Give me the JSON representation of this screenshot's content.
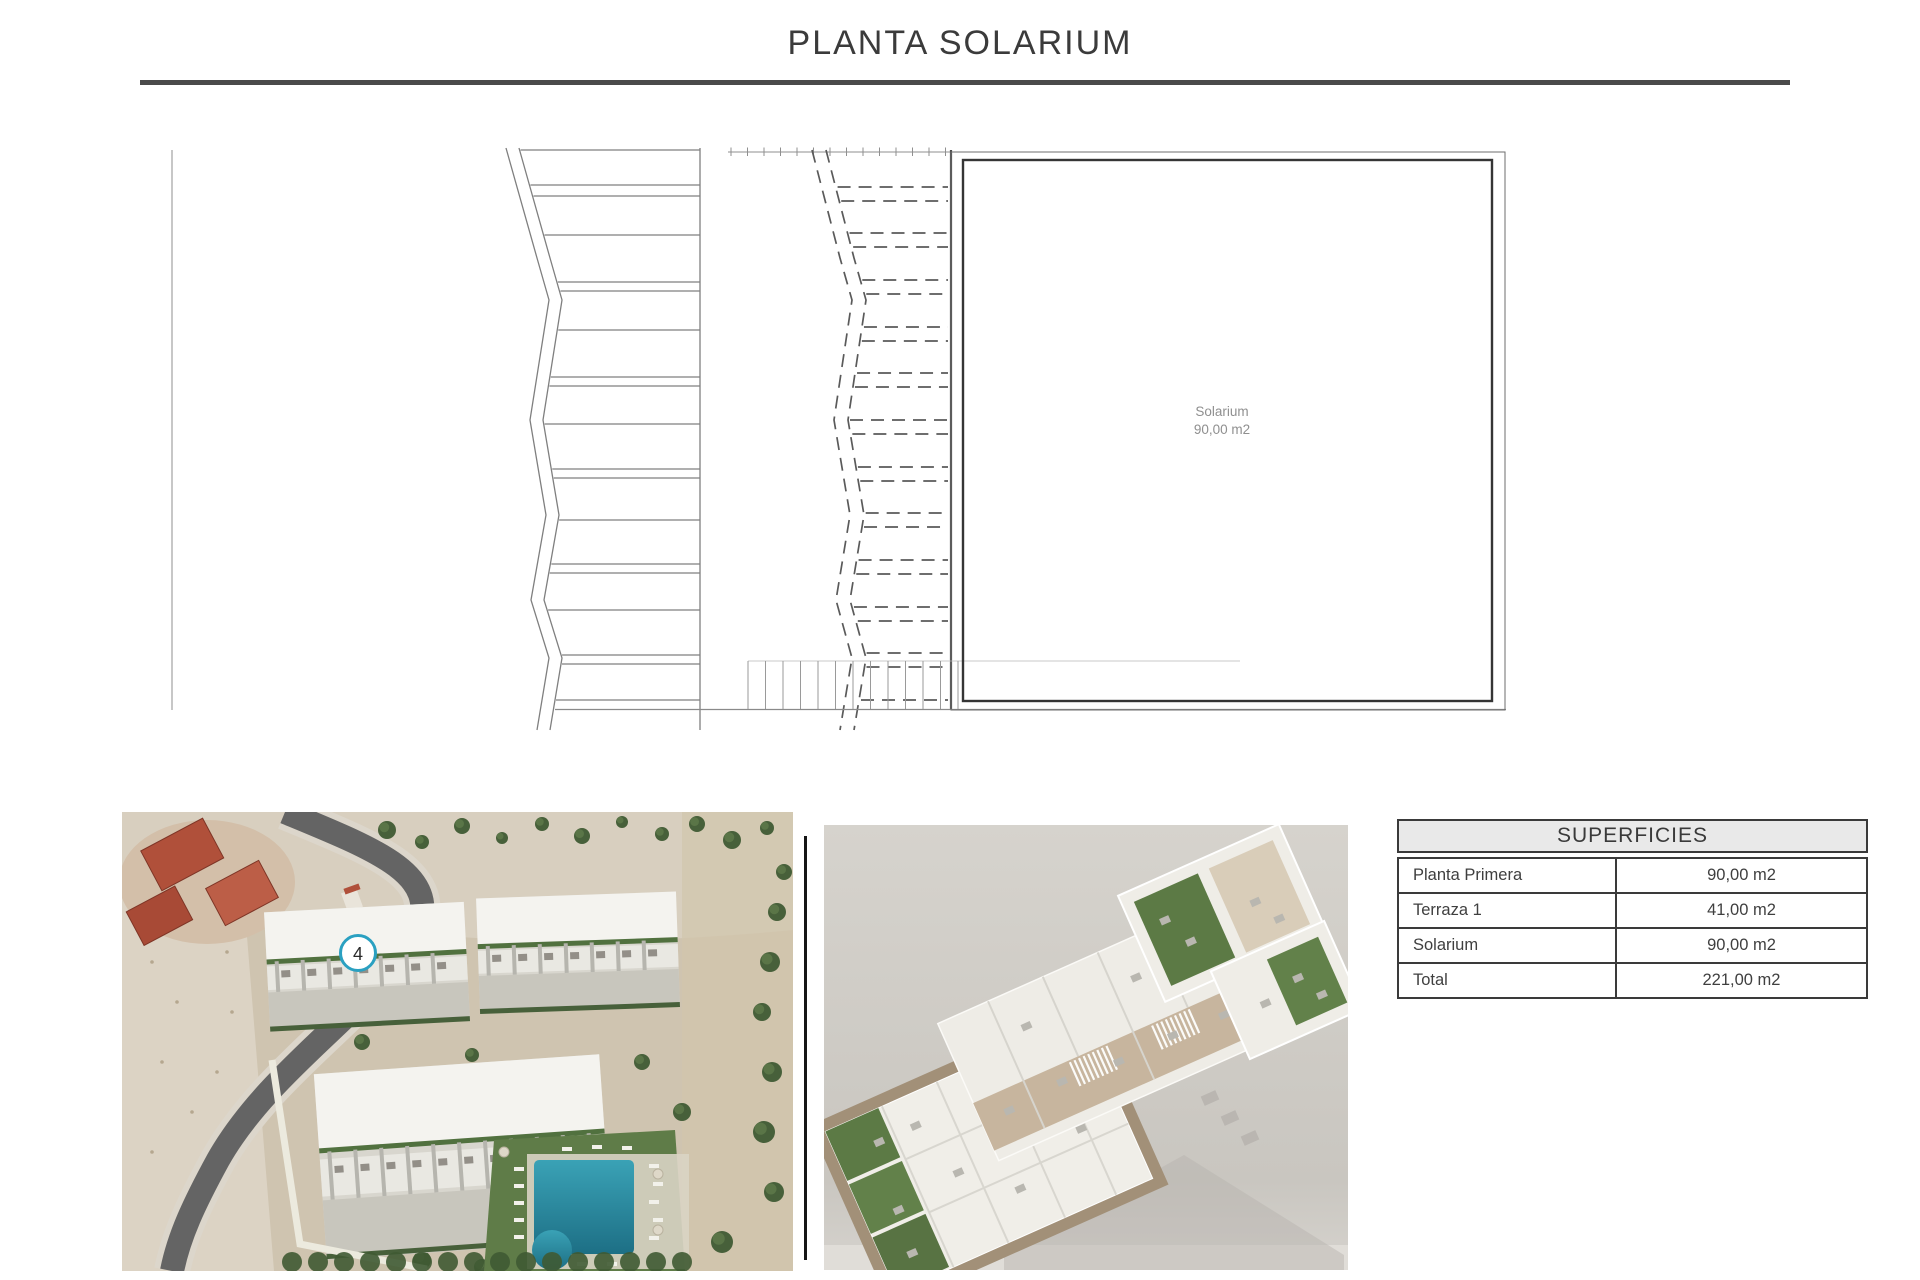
{
  "page": {
    "title": "PLANTA SOLARIUM"
  },
  "plan": {
    "room_label": "Solarium",
    "room_area": "90,00 m2"
  },
  "site_photo": {
    "unit_marker": "4"
  },
  "surfaces_table": {
    "title": "SUPERFICIES",
    "rows": [
      {
        "label": "Planta Primera",
        "value": "90,00 m2"
      },
      {
        "label": "Terraza 1",
        "value": "41,00 m2"
      },
      {
        "label": "Solarium",
        "value": "90,00 m2"
      },
      {
        "label": "Total",
        "value": "221,00 m2"
      }
    ]
  },
  "colors": {
    "accent": "#2aa0c1",
    "title_rule": "#4a4a4a",
    "table_border": "#3a3a3a",
    "table_header_bg": "#e9e9e9",
    "pool_blue": "#2a8ba0",
    "garden_green": "#5c7a45",
    "render_bg": "#d2cfc9"
  }
}
